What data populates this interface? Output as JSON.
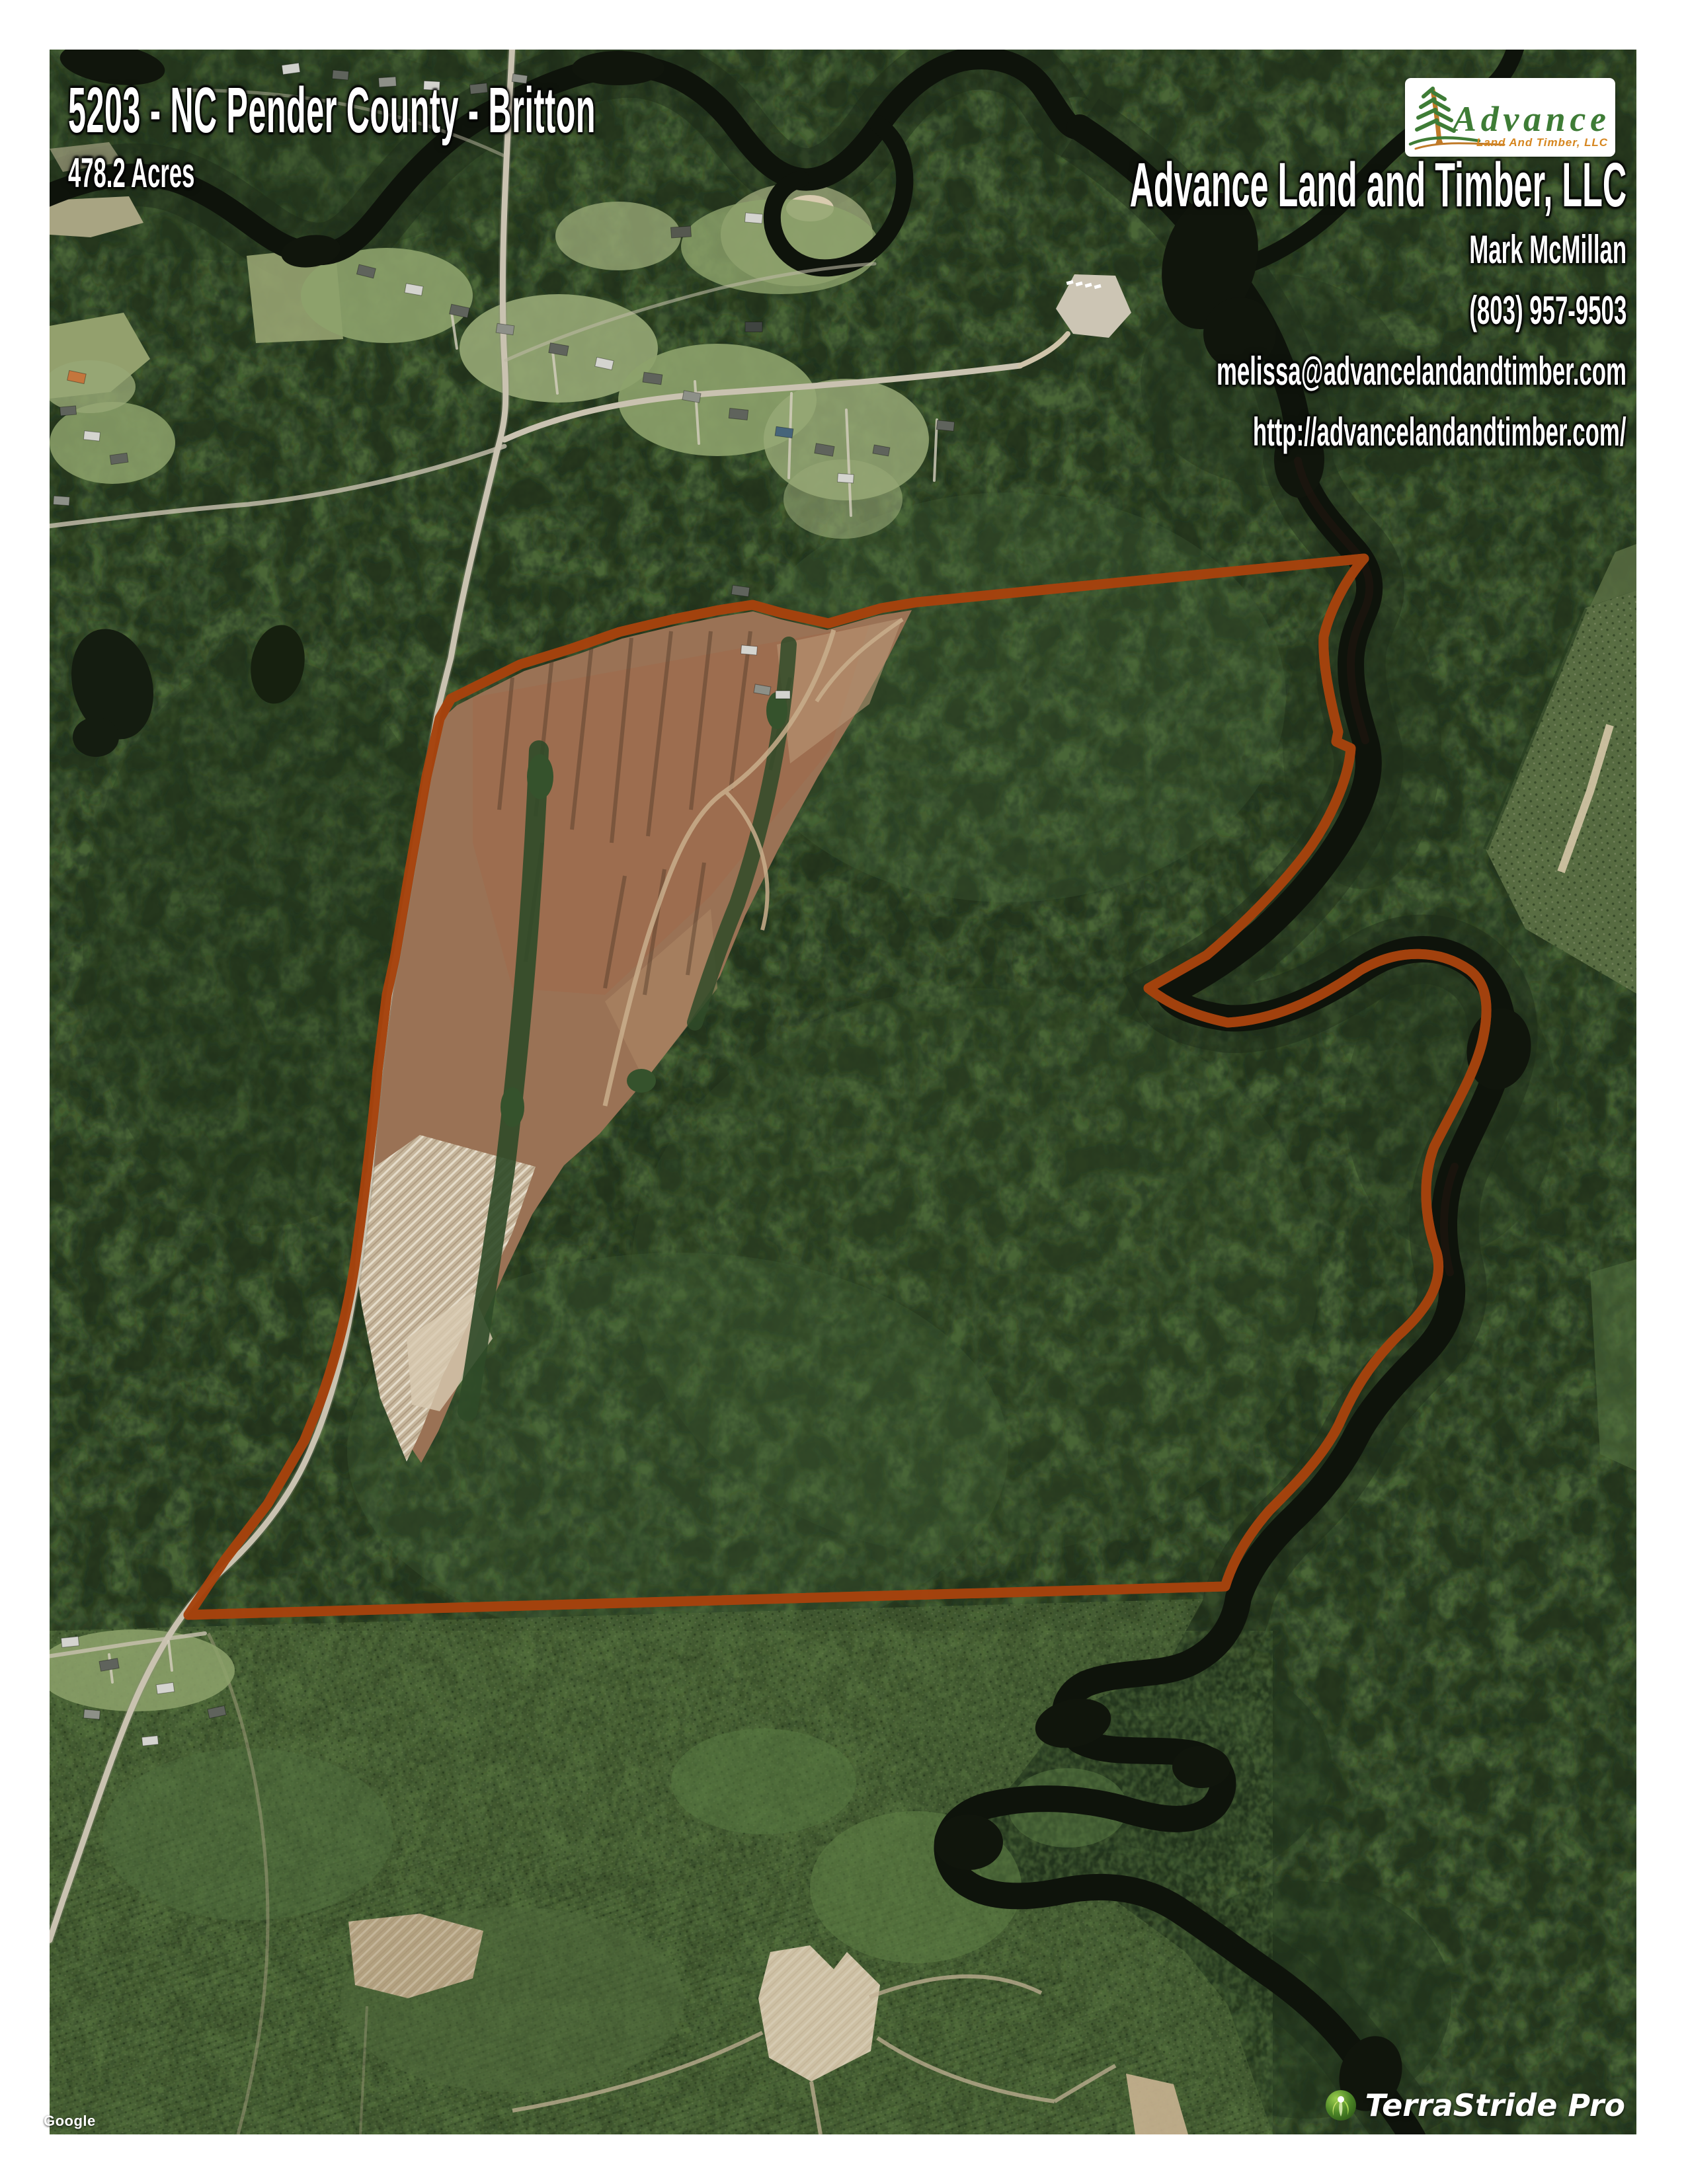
{
  "header": {
    "title": "5203 - NC Pender County - Britton",
    "acres": "478.2 Acres"
  },
  "contact": {
    "company": "Advance Land and Timber, LLC",
    "agent": "Mark McMillan",
    "phone": "(803) 957-9503",
    "email": "melissa@advancelandandtimber.com",
    "website": "http://advancelandandtimber.com/"
  },
  "logo": {
    "brand": "Advance",
    "tagline": "Land And Timber, LLC",
    "brand_color": "#3e7c36",
    "tagline_color": "#d6861f"
  },
  "map": {
    "watermark": "TerraStride Pro",
    "provider_credit": "Google",
    "boundary_color": "#e8611a",
    "imagery_type": "satellite"
  }
}
